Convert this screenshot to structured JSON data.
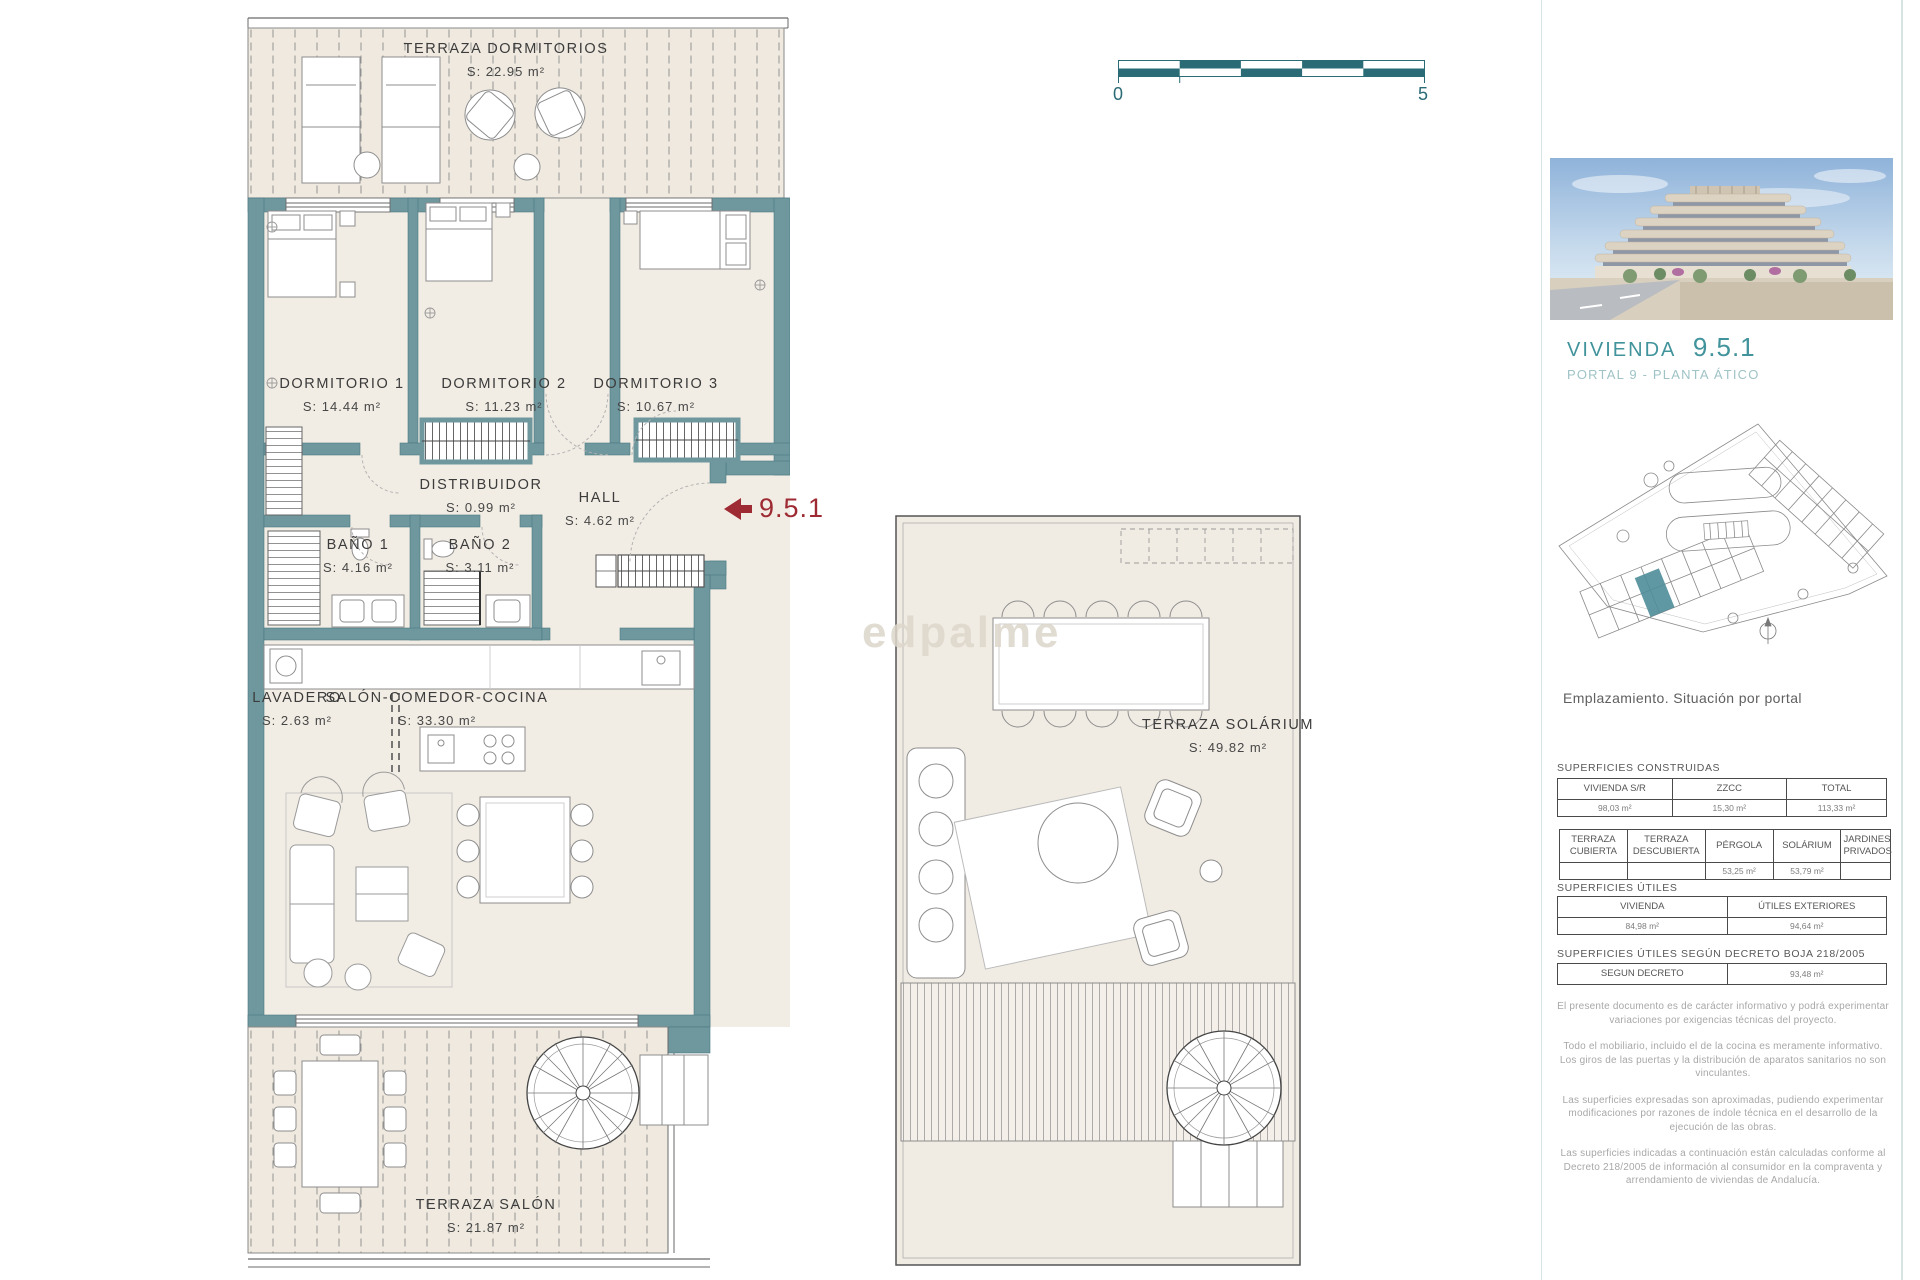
{
  "scale_bar": {
    "min": "0",
    "max": "5"
  },
  "watermark": "edpalme",
  "entrance_marker": {
    "label": "9.5.1"
  },
  "plan": {
    "terraza_dormitorios": {
      "name": "TERRAZA DORMITORIOS",
      "area": "S: 22.95 m²"
    },
    "dormitorio1": {
      "name": "DORMITORIO 1",
      "area": "S: 14.44 m²"
    },
    "dormitorio2": {
      "name": "DORMITORIO 2",
      "area": "S: 11.23 m²"
    },
    "dormitorio3": {
      "name": "DORMITORIO 3",
      "area": "S: 10.67 m²"
    },
    "distribuidor": {
      "name": "DISTRIBUIDOR",
      "area": "S: 0.99 m²"
    },
    "hall": {
      "name": "HALL",
      "area": "S: 4.62 m²"
    },
    "bano1": {
      "name": "BAÑO 1",
      "area": "S: 4.16 m²"
    },
    "bano2": {
      "name": "BAÑO 2",
      "area": "S: 3.11 m²"
    },
    "lavadero": {
      "name": "LAVADERO",
      "area": "S: 2.63 m²"
    },
    "salon": {
      "name": "SALÓN-COMEDOR-COCINA",
      "area": "S: 33.30 m²"
    },
    "terraza_salon": {
      "name": "TERRAZA SALÓN",
      "area": "S: 21.87 m²"
    },
    "terraza_solarium": {
      "name": "TERRAZA SOLÁRIUM",
      "area": "S: 49.82 m²"
    }
  },
  "sidebar": {
    "title": "VIVIENDA",
    "unit": "9.5.1",
    "subtitle": "PORTAL 9 - PLANTA ÁTICO",
    "caption": "Emplazamiento. Situación por portal",
    "superficies_construidas": {
      "title": "SUPERFICIES CONSTRUIDAS",
      "table1": {
        "headers": [
          "VIVIENDA S/R",
          "ZZCC",
          "TOTAL"
        ],
        "values": [
          "98,03 m²",
          "15,30 m²",
          "113,33 m²"
        ]
      },
      "table2": {
        "headers": [
          "TERRAZA CUBIERTA",
          "TERRAZA DESCUBIERTA",
          "PÉRGOLA",
          "SOLÁRIUM",
          "JARDINES PRIVADOS"
        ],
        "values": [
          "",
          "",
          "53,25 m²",
          "53,79 m²",
          ""
        ]
      }
    },
    "superficies_utiles": {
      "title": "SUPERFICIES ÚTILES",
      "headers": [
        "VIVIENDA",
        "ÚTILES EXTERIORES"
      ],
      "values": [
        "84,98 m²",
        "94,64 m²"
      ]
    },
    "superficies_decreto": {
      "title": "SUPERFICIES ÚTILES SEGÚN DECRETO BOJA 218/2005",
      "header": "SEGUN DECRETO",
      "value": "93,48 m²"
    },
    "disclaimers": [
      "El presente documento es de carácter informativo y podrá experimentar variaciones por exigencias técnicas del proyecto.",
      "Todo el mobiliario, incluido el de la cocina es meramente informativo. Los giros de las puertas y la distribución de aparatos sanitarios no son vinculantes.",
      "Las superficies expresadas son aproximadas, pudiendo experimentar modificaciones por razones de índole técnica en el desarrollo de la ejecución de las obras.",
      "Las superficies indicadas a continuación están calculadas conforme al Decreto 218/2005 de información al consumidor en la compraventa y arrendamiento de viviendas de Andalucía."
    ]
  },
  "colors": {
    "wall_teal": "#6f979e",
    "accent_teal": "#2a6b76",
    "title_teal": "#41939c",
    "subtitle_teal": "#9fc3c6",
    "marker_red": "#9e2a33",
    "floor_cream": "#f0ebe2",
    "highlight_unit": "#4e8d98"
  }
}
